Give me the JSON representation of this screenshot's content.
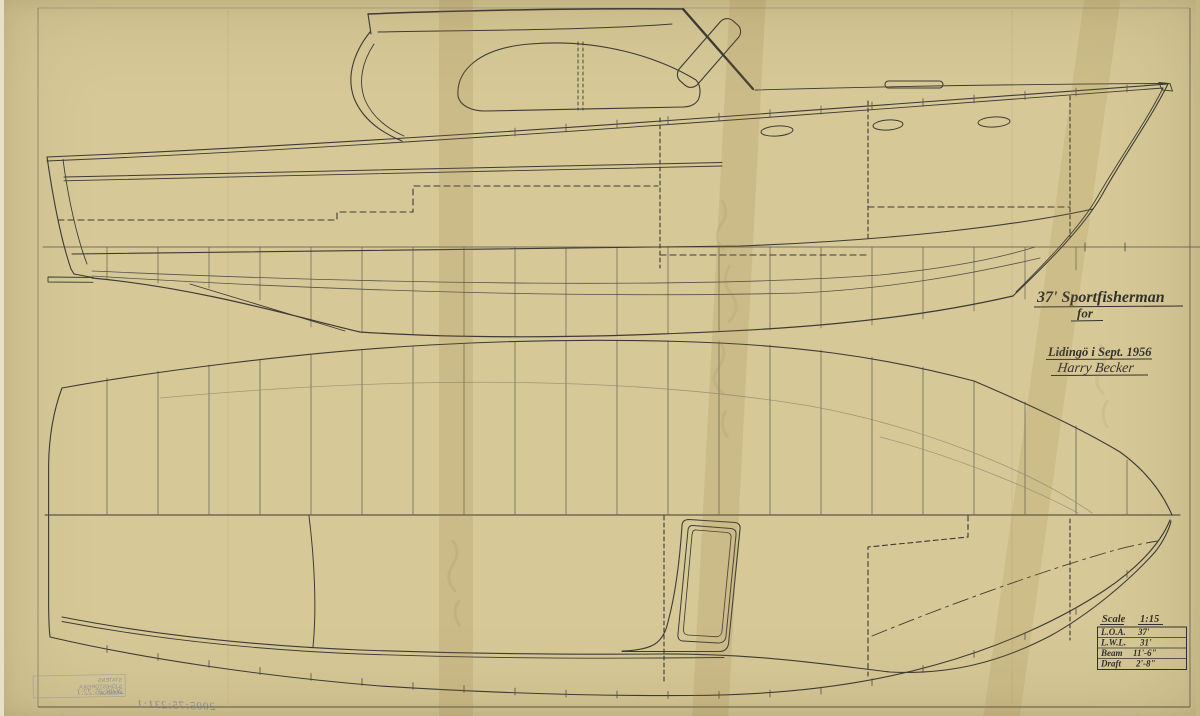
{
  "sheet": {
    "title_line1": "37' Sportfisherman",
    "title_line2": "for",
    "place_date": "Lidingö i Sept. 1956",
    "signature": "Harry Becker",
    "scale": {
      "label": "Scale",
      "value": "1:15"
    },
    "specs": {
      "rows": [
        {
          "label": "L.O.A.",
          "value": "37'"
        },
        {
          "label": "L.W.L.",
          "value": "31'"
        },
        {
          "label": "Beam",
          "value": "11'-6\""
        },
        {
          "label": "Draft",
          "value": "2'-8\""
        }
      ]
    },
    "stamp": {
      "line1": "STATENS",
      "line2": "SJÖHISTORISKA",
      "line3": "MUSEUM",
      "number": "2608:25:22:1"
    },
    "accession_number": "2005:75:231:1"
  },
  "colors": {
    "paper": "#d6c997",
    "ink": "#3d3b34",
    "faint_ink": "#6b675c",
    "stamp_blue": "#7d8498",
    "tape": "#96793f"
  }
}
